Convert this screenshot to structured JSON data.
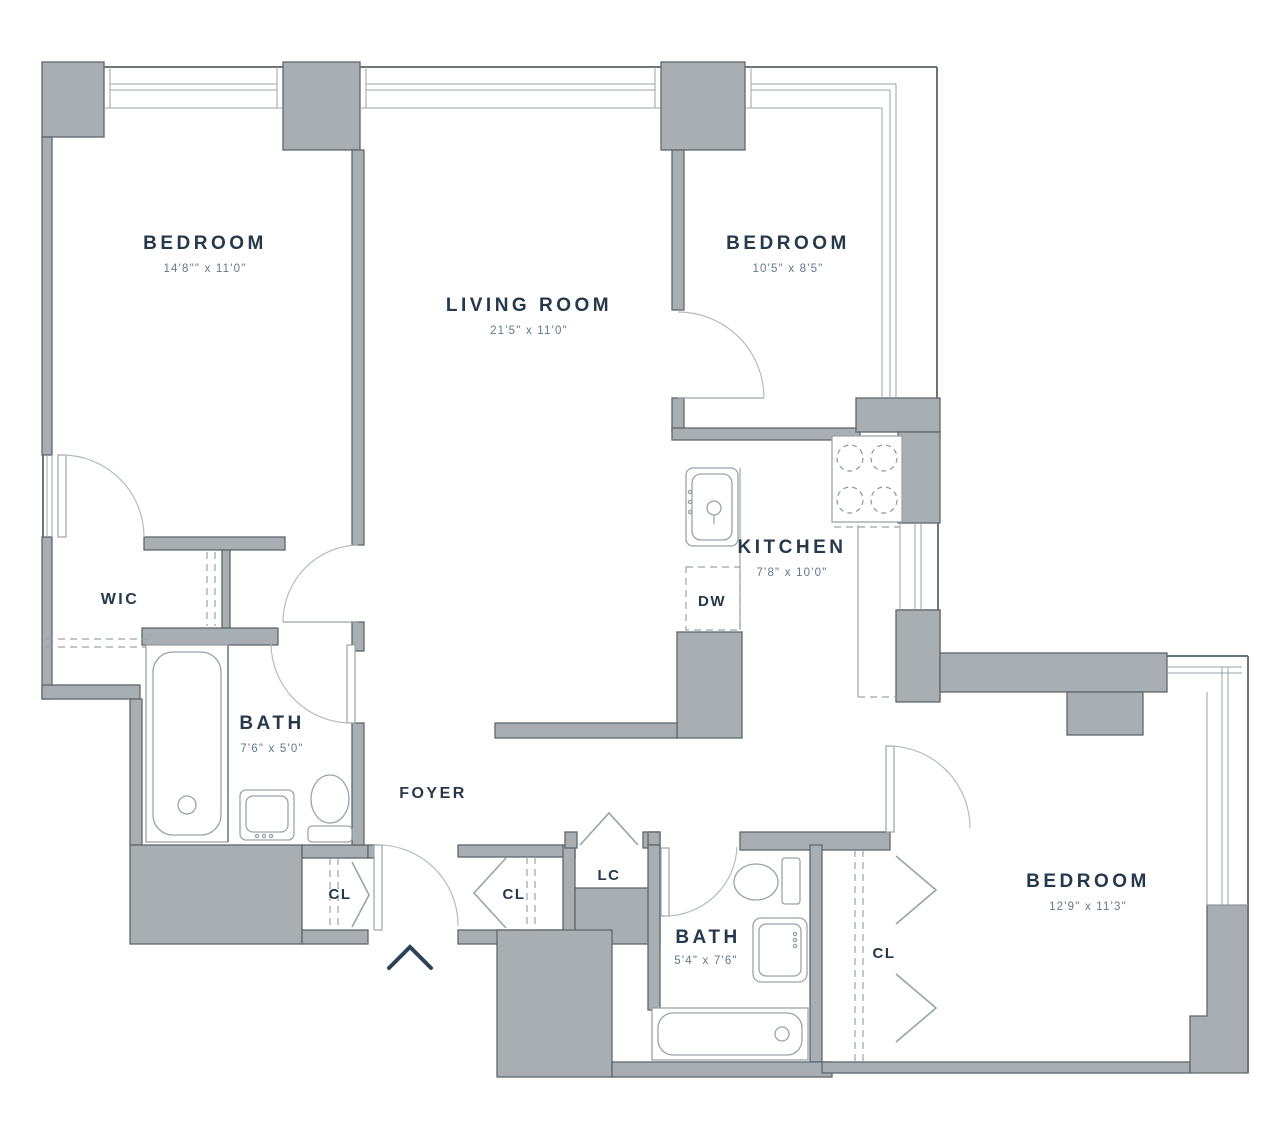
{
  "plan": {
    "title": "two-bedroom-apartment-floor-plan",
    "rooms": {
      "bedroom1": {
        "label": "BEDROOM",
        "dims": "14'8\"\" x 11'0\""
      },
      "living": {
        "label": "LIVING ROOM",
        "dims": "21'5\" x 11'0\""
      },
      "bedroom2": {
        "label": "BEDROOM",
        "dims": "10'5\" x 8'5\""
      },
      "kitchen": {
        "label": "KITCHEN",
        "dims": "7'8\" x 10'0\""
      },
      "wic": {
        "label": "WIC"
      },
      "bath1": {
        "label": "BATH",
        "dims": "7'6\" x 5'0\""
      },
      "foyer": {
        "label": "FOYER"
      },
      "cl_foyer_west": {
        "label": "CL"
      },
      "cl_foyer_east": {
        "label": "CL"
      },
      "lc": {
        "label": "LC"
      },
      "bath2": {
        "label": "BATH",
        "dims": "5'4\" x 7'6\""
      },
      "bedroom3": {
        "label": "BEDROOM",
        "dims": "12'9\" x 11'3\""
      },
      "cl_bedroom3": {
        "label": "CL"
      },
      "dw": {
        "label": "DW"
      }
    },
    "colors": {
      "wall_fill": "#a9aeb2",
      "wall_stroke": "#5e676d",
      "thin_line": "#9aa3a9",
      "label_text": "#25394b",
      "dim_text": "#64788a"
    }
  }
}
